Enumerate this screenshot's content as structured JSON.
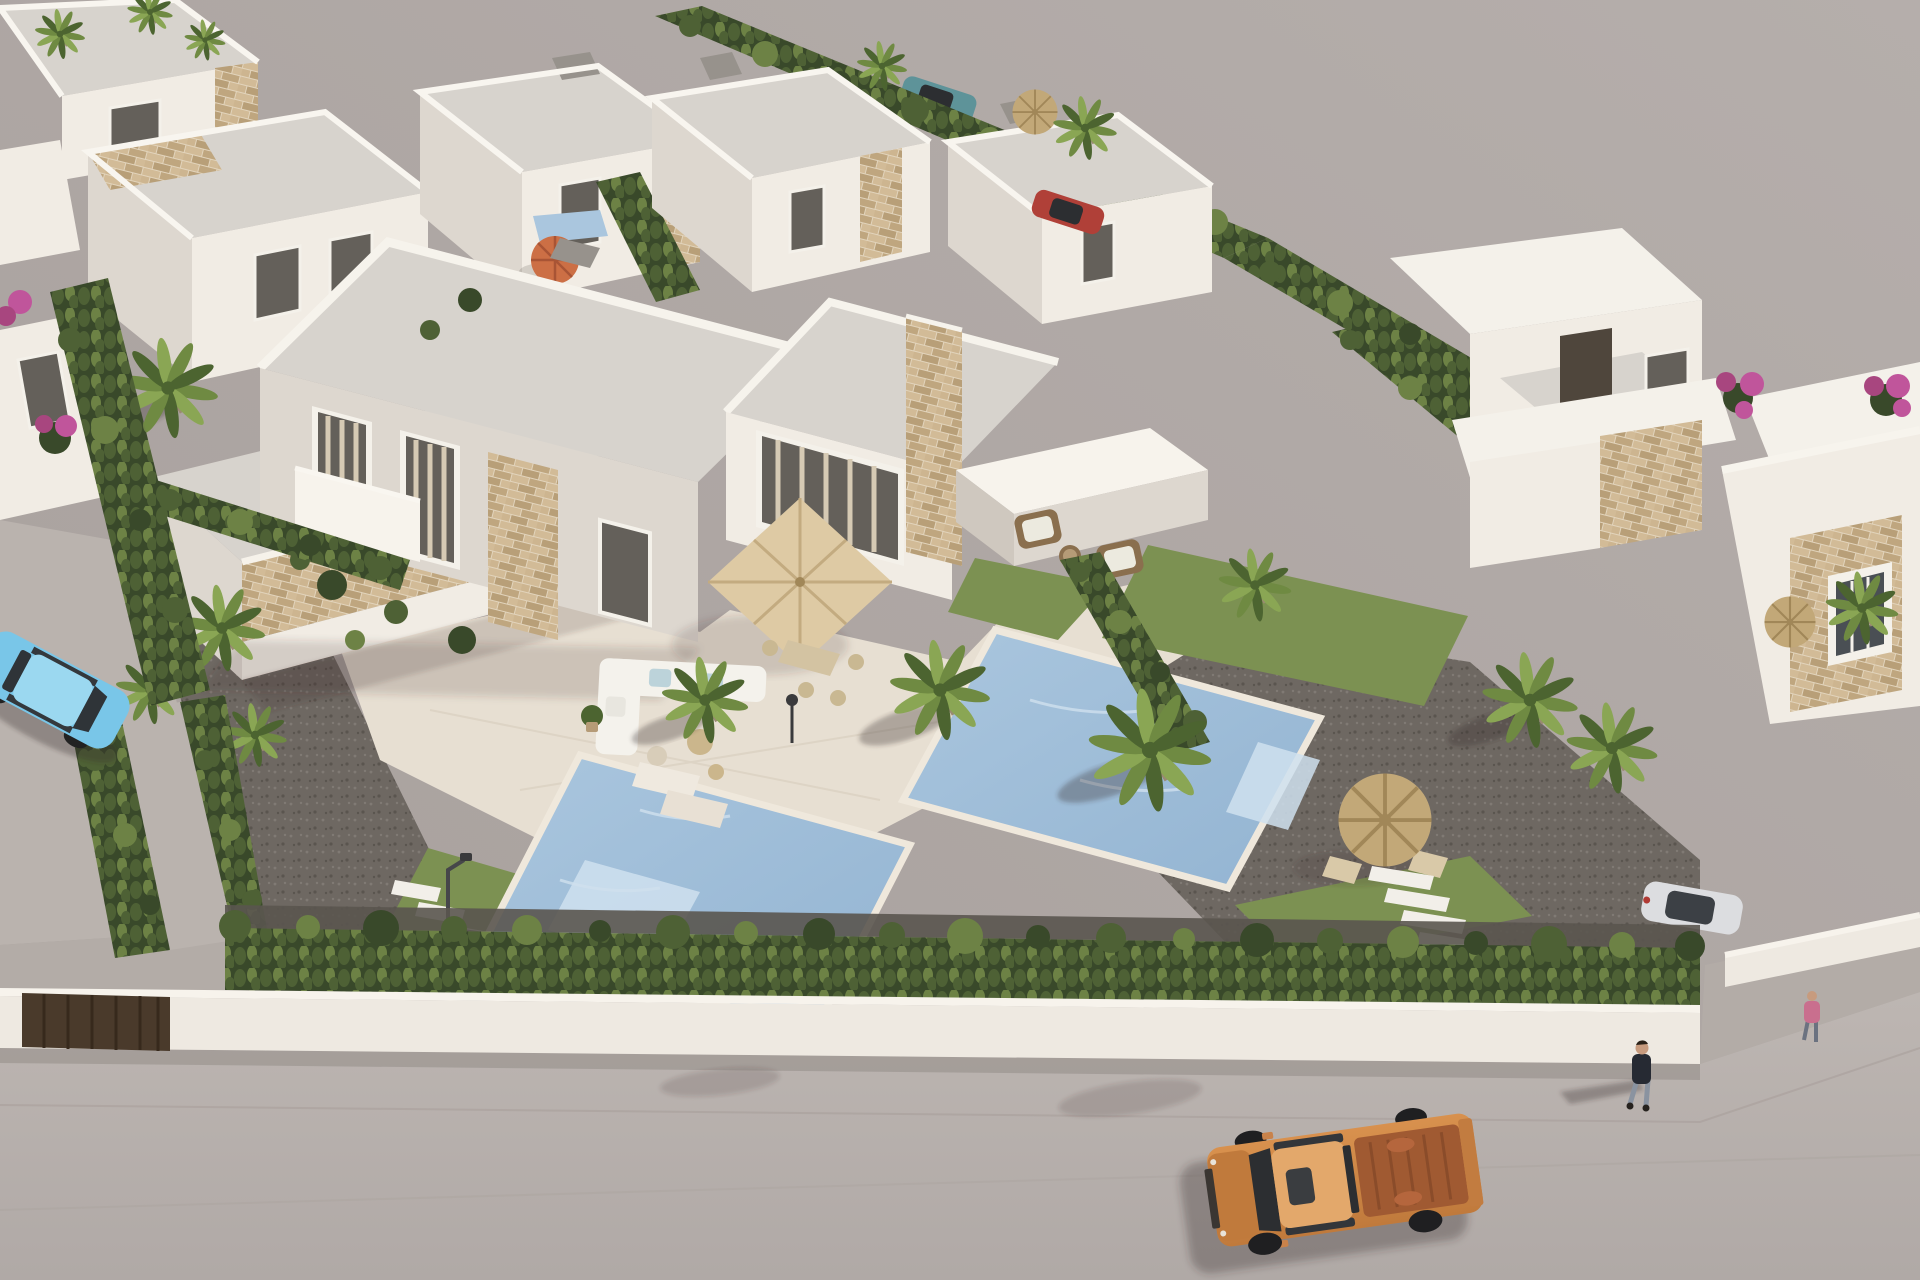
{
  "scene": {
    "type": "3d-architectural-aerial-render",
    "view": "high-angle aerial of a Mediterranean new-build villa development, sun from upper right, long shadows to lower left",
    "elements": [
      {
        "name": "main-duplex-villa",
        "description": "two-story white semi-detached villa with beige stone accent columns, glazed doors with curtains, white parapets and gray flat roof"
      },
      {
        "name": "left-pool",
        "description": "private pool with mosaic bottom for the left unit"
      },
      {
        "name": "right-pool",
        "description": "private pool with steps for the right unit"
      },
      {
        "name": "terrace",
        "description": "pale tiled terrace with square beige parasol, dining set, white lounge sofa, sun loungers and wicker armchairs"
      },
      {
        "name": "gardens",
        "description": "dark gravel beds, lawn strips, cypress boundary hedges, palm trees and shrubs"
      },
      {
        "name": "garden-palapa",
        "description": "thatched umbrella with two chairs in the right garden"
      },
      {
        "name": "stepping-stones",
        "description": "white slab paths in left and right gardens with street lamp and drain grate"
      },
      {
        "name": "perimeter-wall",
        "description": "low white wall along the street with dark brown entrance gate"
      },
      {
        "name": "street",
        "description": "light gray asphalt street along the bottom edge"
      },
      {
        "name": "open-ground",
        "description": "large empty paved area at upper right"
      },
      {
        "name": "background-villas",
        "description": "rows of similar white flat-roof villas with stone trims, chimneys and hedges at top left, top center and right"
      },
      {
        "name": "orange-umbrella",
        "description": "orange parasol beside a neighbouring pool at upper left"
      },
      {
        "name": "bougainvillea",
        "description": "magenta flowering shrubs near right-edge villa and left edge"
      },
      {
        "name": "pickup-truck",
        "description": "orange double-cab pickup with open copper-colored bed driving on the street"
      },
      {
        "name": "light-blue-car",
        "description": "light blue sedan parked at the left edge driveway"
      },
      {
        "name": "teal-car",
        "description": "small teal car on the far side of the top hedge"
      },
      {
        "name": "red-car",
        "description": "small red car parked by the top-center villas"
      },
      {
        "name": "white-parked-car",
        "description": "white car behind the hedge near the right driveway"
      },
      {
        "name": "pedestrian",
        "description": "person in dark top and jeans walking along the street casting a long shadow"
      },
      {
        "name": "second-pedestrian",
        "description": "smaller figure in pink near the right driveway"
      }
    ]
  },
  "colors": {
    "ground": "#a79f9c",
    "ground_light": "#b5aeab",
    "street": "#bdb6b2",
    "street_dark": "#b0a9a6",
    "wall": "#eee9e1",
    "wall_cap": "#f7f3ec",
    "gate": "#4a3a2b",
    "gate_dark": "#37291c",
    "building": "#f1ece4",
    "building_shade": "#ddd7cf",
    "building_dark": "#cfc8bf",
    "roof": "#d7d3cd",
    "roof_light": "#f4f1ea",
    "roof_dark": "#97928c",
    "stone": "#e2d4bc",
    "stone_a": "#d2bb97",
    "stone_b": "#bfa67f",
    "stone_c": "#cdb590",
    "stone_d": "#b89f78",
    "glass": "#64605a",
    "frame": "#f4f1ea",
    "curtain": "#d6cab4",
    "terrace": "#e7dfd2",
    "terrace_line": "#d9cfbf",
    "hedge": "#4e6135",
    "hedge_light": "#6d8245",
    "hedge_dark": "#39492a",
    "grass": "#7c9152",
    "grass_dark": "#637a40",
    "gravel": "#6e6862",
    "gravel_dot": "#807a74",
    "gravel_dark": "#5a554f",
    "water": "#aac6de",
    "water_deep": "#93b4d2",
    "water_light": "#cfe0ee",
    "coping": "#efe8dc",
    "parasol": "#decaa4",
    "parasol_rib": "#c3ab80",
    "palapa": "#c2a878",
    "palapa_rib": "#a18758",
    "palm": "#6f8a42",
    "palm_light": "#8aa654",
    "palm_dark": "#4c6430",
    "trunk": "#9a8a72",
    "truck": "#d8914e",
    "truck_dark": "#c07a3c",
    "truck_bed": "#a05a32",
    "truck_glass": "#2c2e31",
    "car_blue": "#79c6e8",
    "car_blue_roof": "#9bd8f0",
    "car_teal": "#5e9399",
    "car_red": "#b04038",
    "car_white": "#dcdde0",
    "flower": "#c0559b",
    "flower2": "#a8467f",
    "umbrella": "#cc6f45",
    "umbrella_rib": "#a85435",
    "skin": "#c79b7e",
    "outfit_dark": "#262a33",
    "outfit_pink": "#c96f8e",
    "jeans": "#8a93a0",
    "lamp": "#46464a",
    "shadow": "rgba(55,48,42,0.32)",
    "shadow_soft": "rgba(55,48,42,0.16)"
  }
}
